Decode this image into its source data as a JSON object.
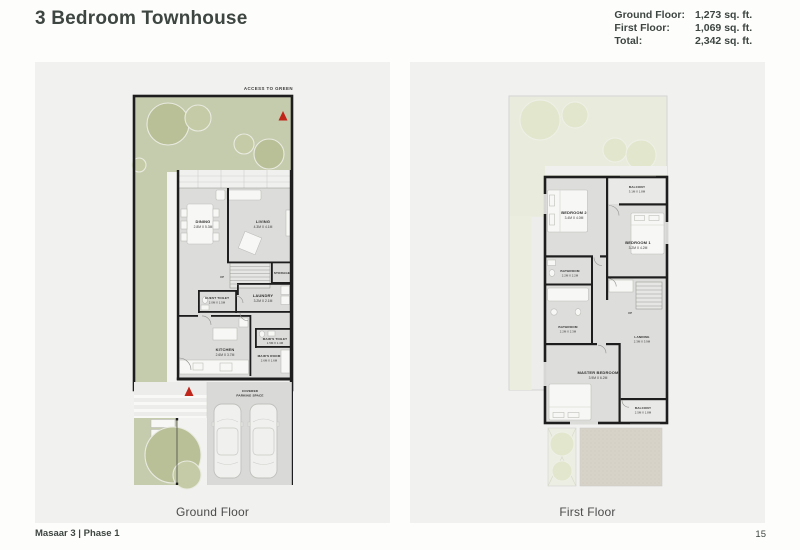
{
  "header": {
    "title": "3 Bedroom Townhouse",
    "stats": [
      {
        "label": "Ground Floor:",
        "value": "1,273 sq. ft."
      },
      {
        "label": "First Floor:",
        "value": "1,069 sq. ft."
      },
      {
        "label": "Total:",
        "value": "2,342 sq. ft."
      }
    ]
  },
  "ground_floor": {
    "caption": "Ground Floor",
    "access_label": "ACCESS TO GREEN",
    "up_label": "UP",
    "parking_line1": "COVERED",
    "parking_line2": "PARKING SPACE",
    "rooms": {
      "dining": {
        "name": "DINING",
        "dims": "2.8M X 5.3M"
      },
      "living": {
        "name": "LIVING",
        "dims": "4.3M X 4.1M"
      },
      "storage": {
        "name": "STORAGE"
      },
      "guest_toilet": {
        "name": "GUEST TOILET",
        "dims": "2.0M X 1.5M"
      },
      "laundry": {
        "name": "LAUNDRY",
        "dims": "3.2M X 2.1M"
      },
      "kitchen": {
        "name": "KITCHEN",
        "dims": "2.6M X 3.7M"
      },
      "maids_toilet": {
        "name": "MAID'S TOILET",
        "dims": "1.5M X 1.4M"
      },
      "maids_room": {
        "name": "MAID'S ROOM",
        "dims": "2.6M X 1.6M"
      }
    }
  },
  "first_floor": {
    "caption": "First Floor",
    "up_label": "UP",
    "rooms": {
      "balcony_top": {
        "name": "BALCONY",
        "dims": "3.1M X 1.8M"
      },
      "bedroom2": {
        "name": "BEDROOM 2",
        "dims": "3.4M X 4.0M"
      },
      "bedroom1": {
        "name": "BEDROOM 1",
        "dims": "3.2M X 4.2M"
      },
      "bathroom_upper": {
        "name": "BATHROOM",
        "dims": "2.2M X 2.2M"
      },
      "bathroom_lower": {
        "name": "BATHROOM",
        "dims": "2.2M X 2.3M"
      },
      "landing": {
        "name": "LANDING",
        "dims": "2.3M X 3.9M"
      },
      "master_bedroom": {
        "name": "MASTER BEDROOM",
        "dims": "3.9M X 6.2M"
      },
      "balcony_bottom": {
        "name": "BALCONY",
        "dims": "2.5M X 1.8M"
      }
    }
  },
  "footer": {
    "project": "Masaar 3 | Phase 1",
    "page_number": "15"
  },
  "colors": {
    "accent_red": "#c1261b",
    "title_text": "#3e4642",
    "garden_green": "#c5cbad",
    "panel_bg": "#f1f1ef"
  }
}
